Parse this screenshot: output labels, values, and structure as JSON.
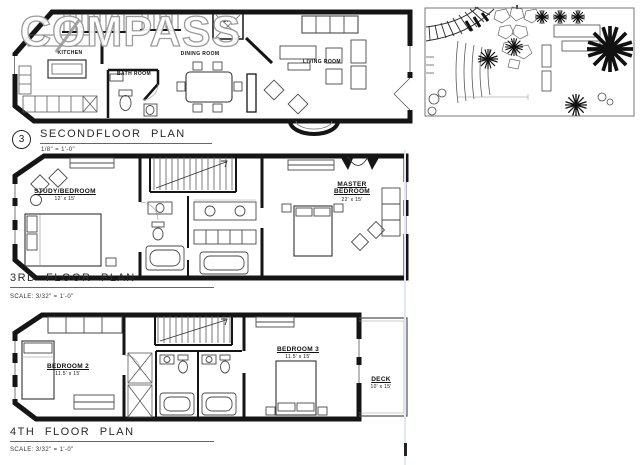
{
  "watermark": "COMPASS",
  "floor2": {
    "marker": "3",
    "title": "SECONDFLOOR PLAN",
    "scale": "1/8\" = 1'-0\"",
    "rooms": {
      "kitchen": "KITCHEN",
      "bath": "BATH ROOM",
      "dining": "DINING ROOM",
      "living": "LIVING ROOM",
      "closet": "CL."
    }
  },
  "floor3": {
    "title": "3RD FLOOR PLAN",
    "scale": "SCALE: 3/32\" = 1'-0\"",
    "rooms": {
      "study": {
        "label": "STUDY/BEDROOM",
        "dims": "12' x 15'"
      },
      "master": {
        "label": "MASTER BEDROOM",
        "dims": "22' x 15'"
      }
    }
  },
  "floor4": {
    "title": "4TH FLOOR PLAN",
    "scale": "SCALE: 3/32\" = 1'-0\"",
    "rooms": {
      "bedroom2": {
        "label": "BEDROOM 2",
        "dims": "11.5' x 15'"
      },
      "bedroom3": {
        "label": "BEDROOM 3",
        "dims": "11.5' x 15'"
      },
      "deck": {
        "label": "DECK",
        "dims": "10' x 15'"
      }
    }
  }
}
